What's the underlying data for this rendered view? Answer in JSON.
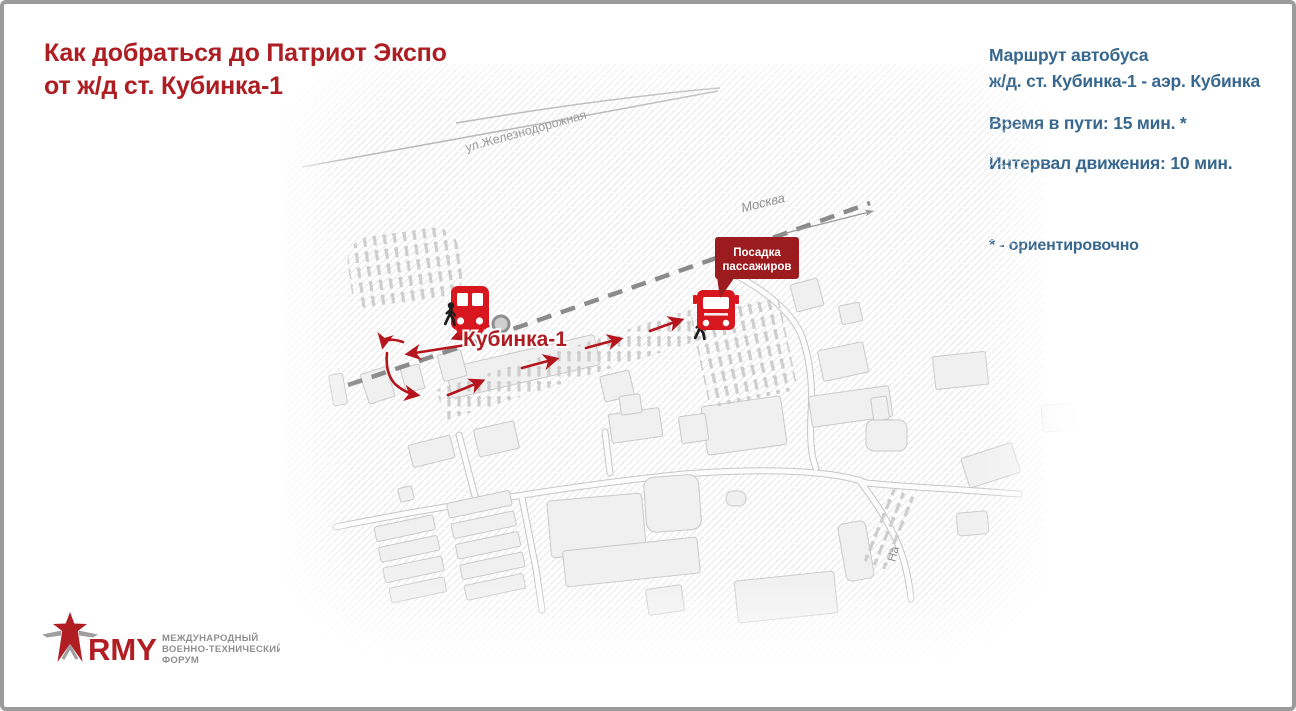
{
  "header": {
    "title_line1": "Как добраться до Патриот Экспо",
    "title_line2": "от ж/д ст. Кубинка-1",
    "color": "#ad1d22"
  },
  "info_panel": {
    "color": "#38678e",
    "route_line1": "Маршрут автобуса",
    "route_line2": "ж/д. ст. Кубинка-1 - аэр. Кубинка",
    "travel_time": "Время в пути: 15 мин. *",
    "interval": "Интервал движения: 10 мин.",
    "footnote": "* - ориентировочно"
  },
  "map": {
    "street_label": "ул.Железнодорожная",
    "direction_label": "Москва",
    "station_label": "Кубинка-1",
    "road_label_partial": "На",
    "callout": {
      "line1": "Посадка",
      "line2": "пассажиров",
      "bg": "#9c1b1f"
    },
    "colors": {
      "walk_arrow_red": "#b5161d",
      "vehicle_red": "#d8161e",
      "railway_dash_gray": "#8b8b8b",
      "building_fill": "#f0f0f0",
      "building_stroke": "#c9c9c9"
    },
    "icons": {
      "train": "train-icon",
      "bus": "bus-icon",
      "pedestrian": "pedestrian-icon",
      "station_marker": "station-marker-icon",
      "direction_arrow": "direction-arrow-icon"
    }
  },
  "logo": {
    "brand_rest": "RMY",
    "caption_line1": "МЕЖДУНАРОДНЫЙ",
    "caption_line2": "ВОЕННО-ТЕХНИЧЕСКИЙ",
    "caption_line3": "ФОРУМ",
    "star_icon": "army-star-icon"
  }
}
